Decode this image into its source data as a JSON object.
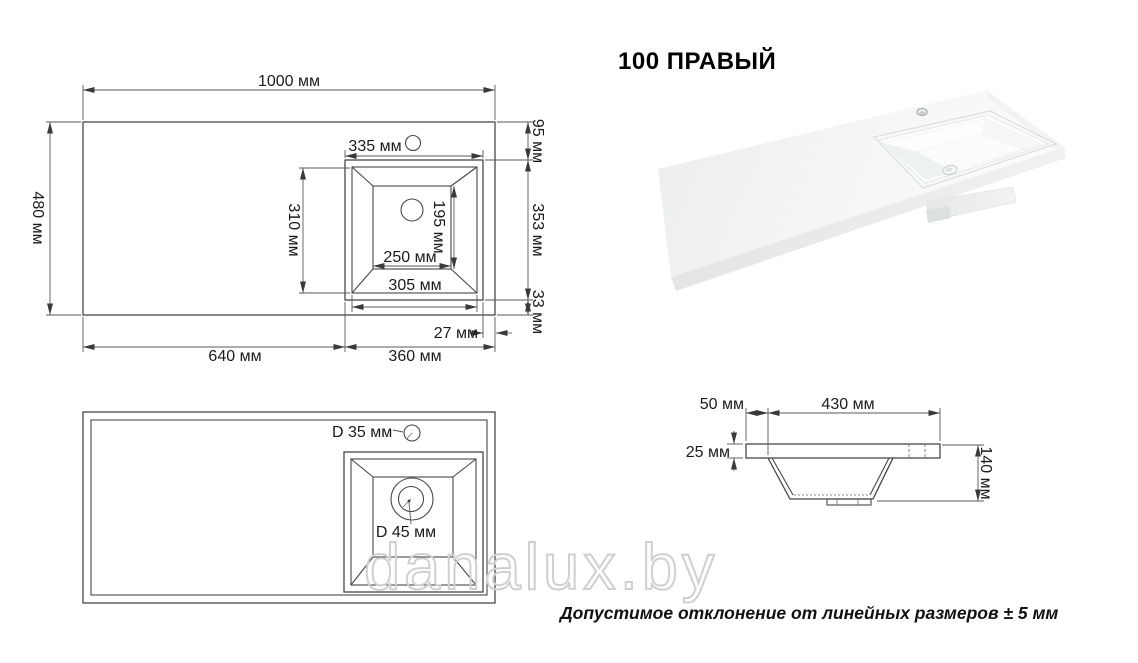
{
  "title": "100 ПРАВЫЙ",
  "note": "Допустимое отклонение от линейных размеров ± 5 мм",
  "watermark": "danalux.by",
  "colors": {
    "background": "#ffffff",
    "drawing_line": "#474747",
    "dimension_line": "#5a5a5a",
    "text": "#1b1b1b",
    "watermark_outline": "#d0d0d0",
    "render_surface_light": "#fafbfb",
    "render_surface_shade": "#e7e9e9"
  },
  "views": {
    "top": {
      "label": "top-view-plan",
      "dims": {
        "total_width": "1000 мм",
        "depth": "480 мм",
        "sink_outer_width": "335 мм",
        "top_offset": "95 мм",
        "sink_outer_height": "353 мм",
        "bottom_offset": "33 мм",
        "rim_height": "310 мм",
        "rim_width": "305 мм",
        "basin_bottom_width": "250 мм",
        "basin_bottom_height": "195 мм",
        "right_offset": "27 мм",
        "left_span": "640 мм",
        "right_span": "360 мм"
      }
    },
    "bottom": {
      "label": "bottom-view-plan",
      "dims": {
        "faucet_hole": "D 35 мм",
        "drain_hole": "D 45 мм"
      }
    },
    "section": {
      "label": "section-view",
      "dims": {
        "edge_offset": "50 мм",
        "basin_width": "430 мм",
        "thickness": "25 мм",
        "height": "140 мм"
      }
    }
  }
}
